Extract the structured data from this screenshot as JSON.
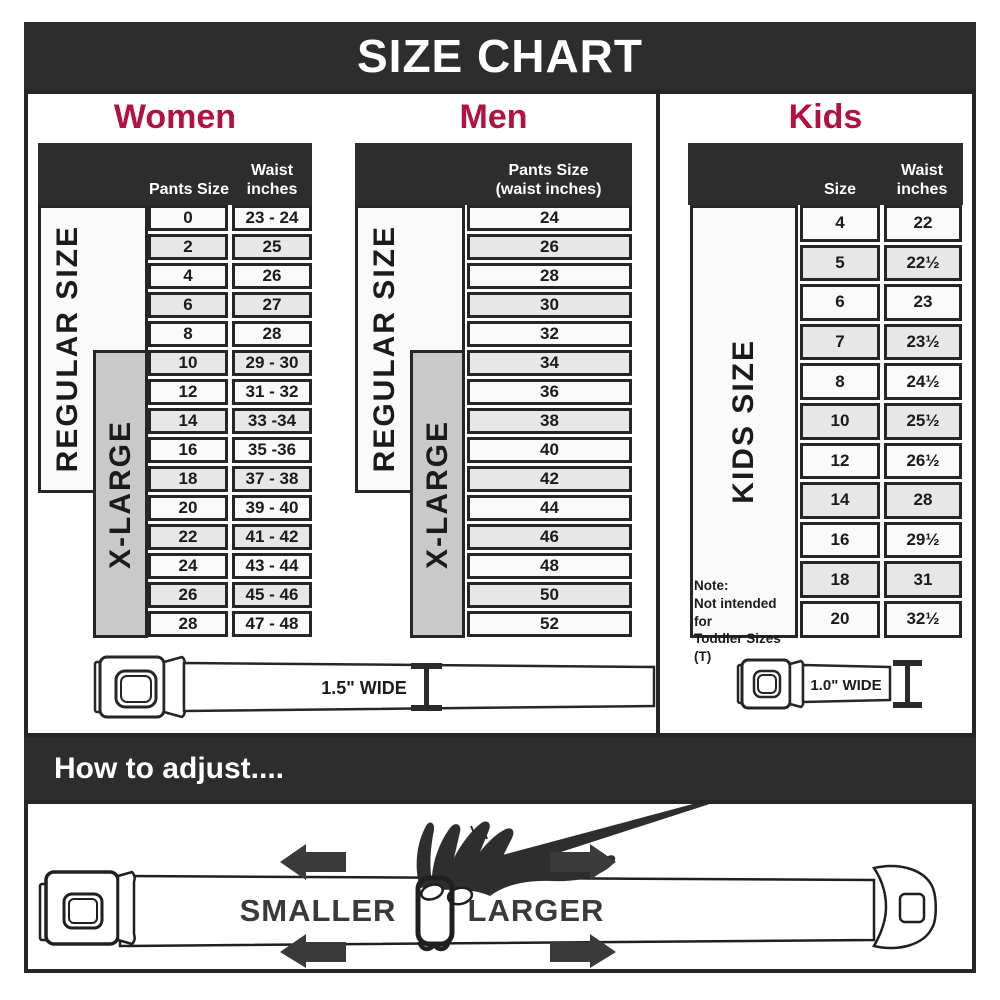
{
  "title": "SIZE CHART",
  "colors": {
    "accent": "#b01341",
    "dark_bar": "#2d2d2d",
    "xlarge_gray": "#c9c9c9",
    "alt_row": "#e7e7e7"
  },
  "sections": {
    "women": {
      "label": "Women",
      "header": {
        "col1": "Pants Size",
        "col2a": "Waist",
        "col2b": "inches"
      },
      "side_labels": {
        "regular": "REGULAR SIZE",
        "xlarge": "X-LARGE"
      },
      "rows": [
        {
          "size": "0",
          "waist": "23 - 24"
        },
        {
          "size": "2",
          "waist": "25"
        },
        {
          "size": "4",
          "waist": "26"
        },
        {
          "size": "6",
          "waist": "27"
        },
        {
          "size": "8",
          "waist": "28"
        },
        {
          "size": "10",
          "waist": "29 - 30"
        },
        {
          "size": "12",
          "waist": "31 - 32"
        },
        {
          "size": "14",
          "waist": "33 -34"
        },
        {
          "size": "16",
          "waist": "35 -36"
        },
        {
          "size": "18",
          "waist": "37 - 38"
        },
        {
          "size": "20",
          "waist": "39 - 40"
        },
        {
          "size": "22",
          "waist": "41 - 42"
        },
        {
          "size": "24",
          "waist": "43 - 44"
        },
        {
          "size": "26",
          "waist": "45 - 46"
        },
        {
          "size": "28",
          "waist": "47 - 48"
        }
      ]
    },
    "men": {
      "label": "Men",
      "header": {
        "line1": "Pants Size",
        "line2": "(waist inches)"
      },
      "side_labels": {
        "regular": "REGULAR SIZE",
        "xlarge": "X-LARGE"
      },
      "rows": [
        "24",
        "26",
        "28",
        "30",
        "32",
        "34",
        "36",
        "38",
        "40",
        "42",
        "44",
        "46",
        "48",
        "50",
        "52"
      ]
    },
    "kids": {
      "label": "Kids",
      "header": {
        "col1": "Size",
        "col2a": "Waist",
        "col2b": "inches"
      },
      "side_label": "KIDS SIZE",
      "note_lines": [
        "Note:",
        "Not intended for",
        "Toddler Sizes (T)"
      ],
      "rows": [
        {
          "size": "4",
          "waist": "22"
        },
        {
          "size": "5",
          "waist": "22½"
        },
        {
          "size": "6",
          "waist": "23"
        },
        {
          "size": "7",
          "waist": "23½"
        },
        {
          "size": "8",
          "waist": "24½"
        },
        {
          "size": "10",
          "waist": "25½"
        },
        {
          "size": "12",
          "waist": "26½"
        },
        {
          "size": "14",
          "waist": "28"
        },
        {
          "size": "16",
          "waist": "29½"
        },
        {
          "size": "18",
          "waist": "31"
        },
        {
          "size": "20",
          "waist": "32½"
        }
      ]
    }
  },
  "belts": {
    "adult_label": "1.5\" WIDE",
    "kids_label": "1.0\" WIDE"
  },
  "adjust": {
    "title": "How to adjust....",
    "smaller_label": "SMALLER",
    "larger_label": "LARGER"
  }
}
